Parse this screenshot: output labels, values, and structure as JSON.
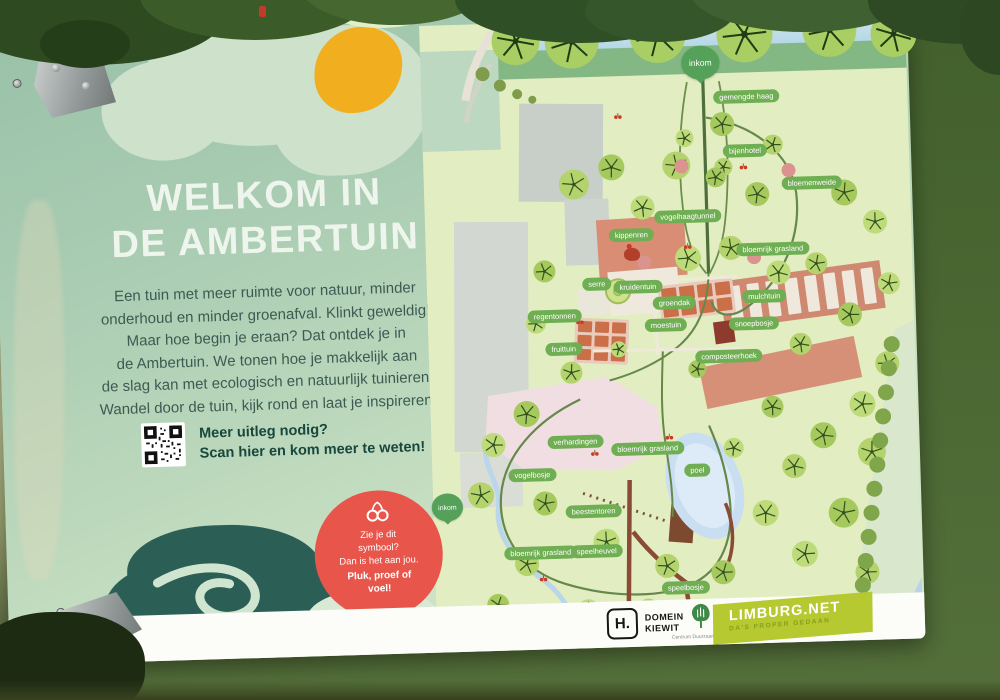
{
  "sign": {
    "title_line1": "WELKOM IN",
    "title_line2": "DE AMBERTUIN",
    "intro_lines": [
      "Een tuin met meer ruimte voor natuur, minder",
      "onderhoud en minder groenafval. Klinkt geweldig!",
      "Maar hoe begin je eraan? Dat ontdek je in",
      "de Ambertuin. We tonen hoe je makkelijk aan",
      "de slag kan met ecologisch en natuurlijk tuinieren.",
      "Wandel door de tuin, kijk rond en laat je inspireren."
    ],
    "qr": {
      "heading": "Meer uitleg nodig?",
      "subheading": "Scan hier en kom meer te weten!"
    },
    "badge": {
      "icon": "cherries-icon",
      "lines": [
        "Zie je dit",
        "symbool?",
        "Dan is het aan jou."
      ],
      "bold_lines": [
        "Pluk, proef of",
        "voel!"
      ]
    }
  },
  "map": {
    "entrance_label": "inkom",
    "labels": [
      "gemengde haag",
      "bijenhotel",
      "bloemenweide",
      "bloemrijk grasland",
      "vogelhaagtunnel",
      "kippenren",
      "serre",
      "kruidentuin",
      "groendak",
      "regentonnen",
      "moestuin",
      "mulchtuin",
      "fruittuin",
      "snoepbosje",
      "composteerhoek",
      "verhardingen",
      "bloemrijk grasland",
      "poel",
      "vogelbosje",
      "beestentoren",
      "bloemrijk grasland",
      "speelheuvel",
      "speelbosje"
    ]
  },
  "footer": {
    "domein_kiewit": {
      "monogram": "H.",
      "name_line1": "DOMEIN",
      "name_line2": "KIEWIT"
    },
    "centrum_duurzaam_groen": {
      "name": "Centrum Duurzaam Groen",
      "icon": "tree-icon"
    },
    "limburg_net": {
      "name": "LIMBURG.NET",
      "tagline": "DA'S PROPER GEDAAN"
    }
  },
  "colors": {
    "accent_pink": "#e8564b",
    "accent_yellow": "#f1af1f",
    "teal_blob": "#2b5f56",
    "label_green": "#6fae52",
    "pin_green": "#55a159",
    "limburg_green": "#b6c930",
    "map_bg": "#e3edc2",
    "sign_green": "#aed0b5"
  }
}
